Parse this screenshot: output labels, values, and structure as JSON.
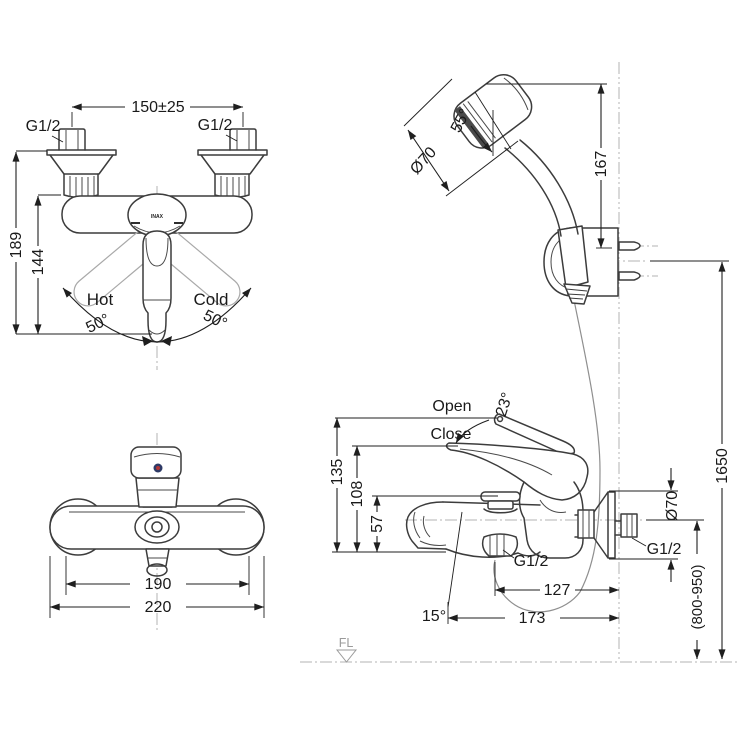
{
  "drawing": {
    "title": "wall-mounted bath shower mixer installation dimensions",
    "front_view": {
      "dim_width": "150±25",
      "thread_left": "G1/2",
      "thread_right": "G1/2",
      "dim_height_total": "189",
      "dim_height_body": "144",
      "label_hot": "Hot",
      "label_cold": "Cold",
      "angle_left": "50°",
      "angle_right": "50°",
      "brand": "INAX"
    },
    "shower_view": {
      "angle_head": "55°",
      "head_diameter": "Ø70",
      "dim_height": "167"
    },
    "side_view": {
      "label_open": "Open",
      "label_close": "Close",
      "angle_handle": "23°",
      "dim_open_height": "135",
      "dim_close_height": "108",
      "dim_diverter_height": "57",
      "thread_outlet": "G1/2",
      "dim_depth_inner": "127",
      "dim_depth_outer": "173",
      "angle_spout": "15°"
    },
    "wall_view": {
      "union_diameter": "Ø70",
      "thread_wall": "G1/2",
      "install_height_range": "(800-950)",
      "total_height": "1650"
    },
    "top_view": {
      "dim_body_width": "190",
      "dim_overall_width": "220"
    },
    "floor": {
      "label": "FL"
    },
    "colors": {
      "line": "#3c3c3c",
      "dimension": "#1f1f1f",
      "ghost": "#a9a9a9",
      "centerline": "#b3b3b3",
      "hose": "#8f8f8f",
      "indicator_ring": "#2e3a66",
      "indicator_dot": "#b23535"
    }
  }
}
